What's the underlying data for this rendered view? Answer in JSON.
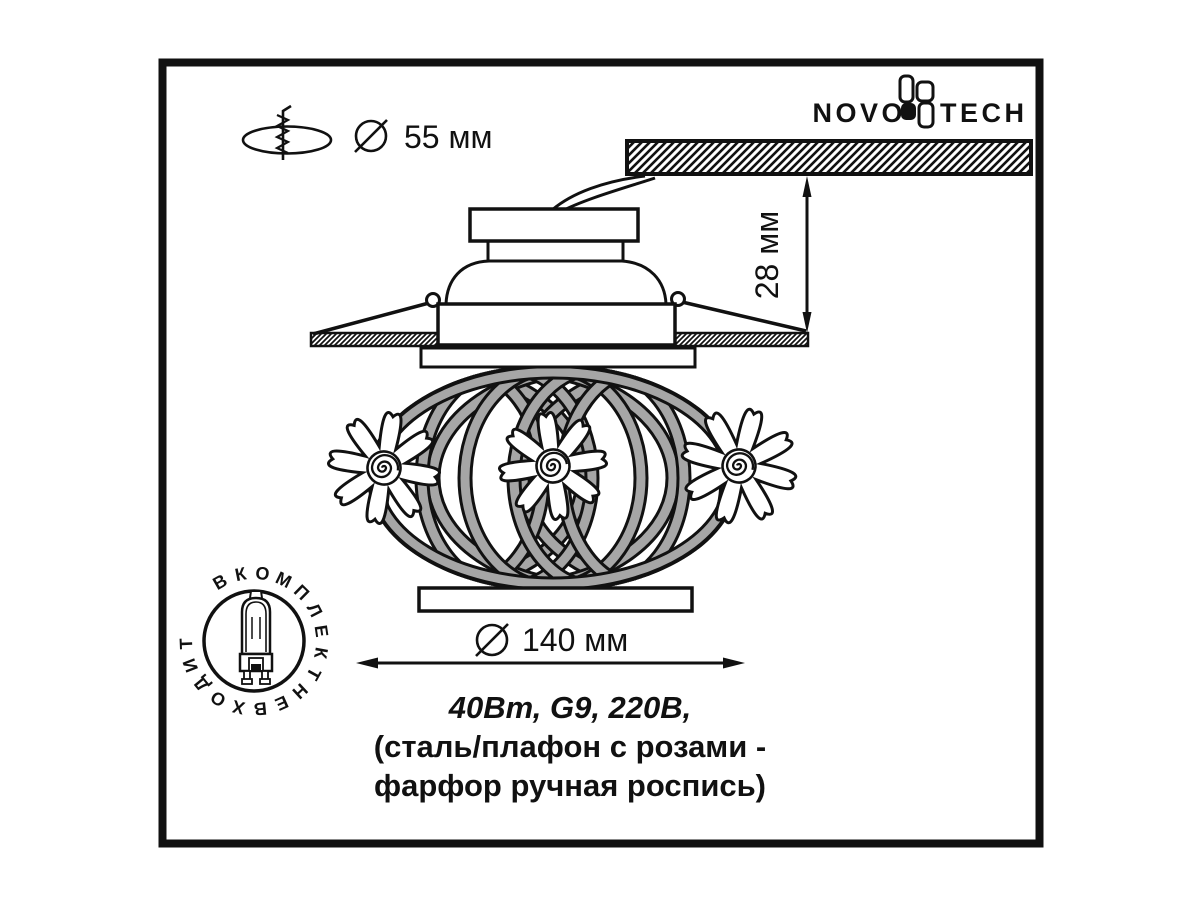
{
  "colors": {
    "ink": "#111111",
    "band_gray": "#a6a6a6",
    "paper": "#ffffff"
  },
  "logo": {
    "left": "NOVO",
    "right": "TECH"
  },
  "dimensions": {
    "hole_diameter": "55 мм",
    "recess_depth": "28 мм",
    "body_diameter": "140 мм"
  },
  "caption": {
    "line1": "40Вт, G9, 220В,",
    "line2": "(сталь/плафон с розами -",
    "line3": "фарфор ручная роспись)"
  },
  "badge": {
    "text": "В КОМПЛЕКТ НЕ ВХОДИТ"
  }
}
